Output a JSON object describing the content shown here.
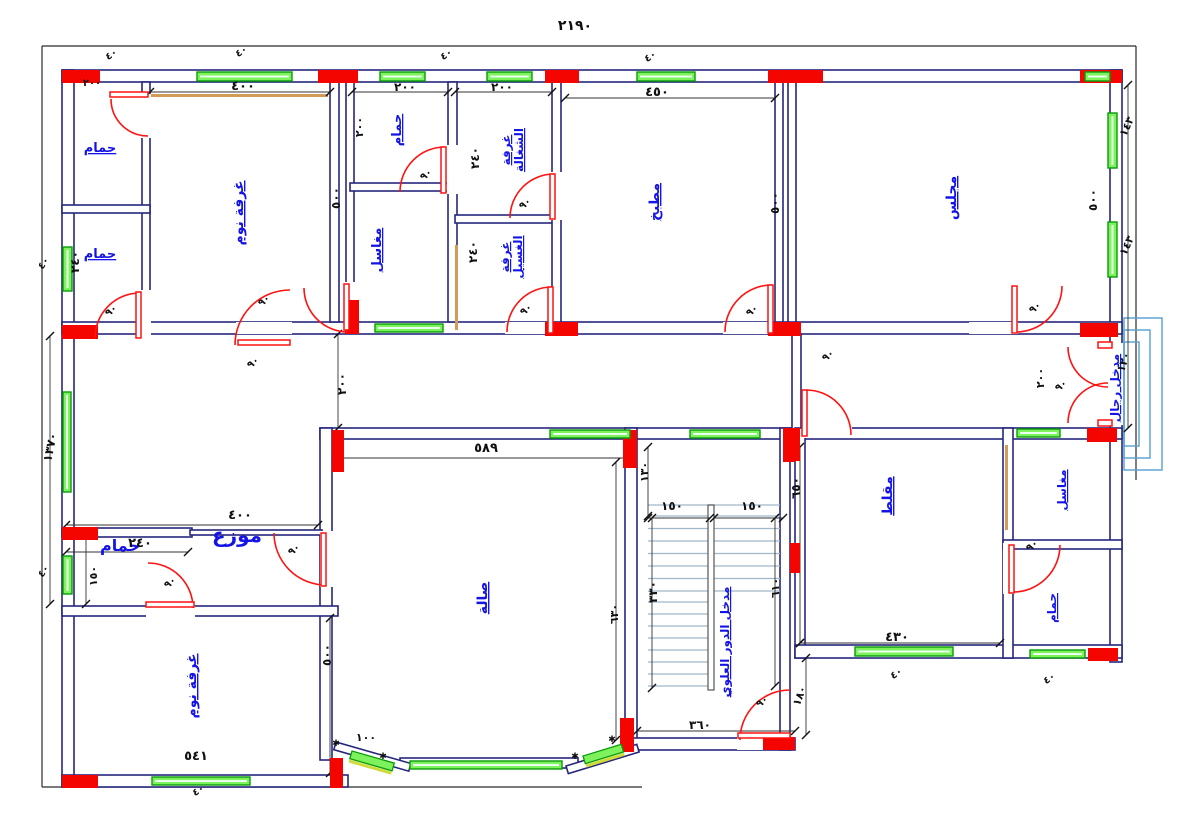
{
  "title": "villa-floor-plan",
  "colors": {
    "wall": "#26267e",
    "boundary": "#2a2a2a",
    "column": "#f50500",
    "window_fill": "#7df25c",
    "window_edge": "#0a9b0a",
    "door": "#ff1212",
    "room_text": "#1414e8",
    "dim_text": "#101010",
    "stairs": "#a0b8ca",
    "entry_steps": "#55a0d0",
    "accent_tan": "#d29b56",
    "bay_accent": "#cddc39"
  },
  "overall_dims": {
    "top_width": "٢١٩٠",
    "left_height": "١٣٧٠"
  },
  "room_labels": [
    {
      "text": "حمام",
      "x": 100,
      "y": 152,
      "rot": 0,
      "size": 13,
      "u": true,
      "stack": false
    },
    {
      "text": "حمام",
      "x": 100,
      "y": 258,
      "rot": 0,
      "size": 13,
      "u": true,
      "stack": false
    },
    {
      "text": "غرفة نوم",
      "x": 243,
      "y": 213,
      "rot": -90,
      "size": 14,
      "u": true,
      "stack": false
    },
    {
      "text": "حمام",
      "x": 401,
      "y": 130,
      "rot": -90,
      "size": 13,
      "u": true,
      "stack": false
    },
    {
      "text": "مغاسل",
      "x": 381,
      "y": 250,
      "rot": -90,
      "size": 13,
      "u": true,
      "stack": false
    },
    {
      "text": "غرفة الشغالة",
      "x": 516,
      "y": 150,
      "rot": -90,
      "size": 12,
      "u": true,
      "stack": true
    },
    {
      "text": "غرفة الغسيل",
      "x": 515,
      "y": 257,
      "rot": -90,
      "size": 12,
      "u": true,
      "stack": true
    },
    {
      "text": "مطبخ",
      "x": 659,
      "y": 202,
      "rot": -90,
      "size": 14,
      "u": true,
      "stack": false
    },
    {
      "text": "مجلس",
      "x": 956,
      "y": 198,
      "rot": -90,
      "size": 14,
      "u": true,
      "stack": false
    },
    {
      "text": "مدخل رجال",
      "x": 1119,
      "y": 388,
      "rot": -90,
      "size": 12,
      "u": true,
      "stack": false
    },
    {
      "text": "مقلط",
      "x": 892,
      "y": 496,
      "rot": -90,
      "size": 14,
      "u": true,
      "stack": false
    },
    {
      "text": "مغاسل",
      "x": 1066,
      "y": 490,
      "rot": -90,
      "size": 12,
      "u": true,
      "stack": false
    },
    {
      "text": "حمام",
      "x": 1056,
      "y": 608,
      "rot": -90,
      "size": 12,
      "u": true,
      "stack": false
    },
    {
      "text": "موزع",
      "x": 237,
      "y": 542,
      "rot": 0,
      "size": 20,
      "u": false,
      "stack": false
    },
    {
      "text": "حمام",
      "x": 120,
      "y": 551,
      "rot": 0,
      "size": 16,
      "u": false,
      "stack": false
    },
    {
      "text": "غرفة نوم",
      "x": 196,
      "y": 686,
      "rot": -90,
      "size": 14,
      "u": true,
      "stack": false
    },
    {
      "text": "صالة",
      "x": 487,
      "y": 598,
      "rot": -90,
      "size": 14,
      "u": true,
      "stack": false
    },
    {
      "text": "مدخل الدور العلوي",
      "x": 729,
      "y": 642,
      "rot": -90,
      "size": 12,
      "u": true,
      "stack": false
    }
  ],
  "dim_labels": [
    {
      "text": "٢١٩٠",
      "x": 575,
      "y": 30,
      "rot": 0,
      "size": 14
    },
    {
      "text": "٤٠٠",
      "x": 243,
      "y": 90,
      "rot": 0,
      "size": 13
    },
    {
      "text": "٢٠٠",
      "x": 405,
      "y": 91,
      "rot": 0,
      "size": 12
    },
    {
      "text": "٢٠٠",
      "x": 502,
      "y": 91,
      "rot": 0,
      "size": 12
    },
    {
      "text": "٤٥٠",
      "x": 657,
      "y": 96,
      "rot": 0,
      "size": 13
    },
    {
      "text": "٢٠٠",
      "x": 92,
      "y": 86,
      "rot": 0,
      "size": 10
    },
    {
      "text": "٥٠٠",
      "x": 340,
      "y": 198,
      "rot": -90,
      "size": 12
    },
    {
      "text": "٢٠٠",
      "x": 363,
      "y": 127,
      "rot": -90,
      "size": 11
    },
    {
      "text": "٢٤٠",
      "x": 479,
      "y": 158,
      "rot": -90,
      "size": 12
    },
    {
      "text": "٢٤٠",
      "x": 477,
      "y": 252,
      "rot": -90,
      "size": 12
    },
    {
      "text": "٥٠٠",
      "x": 779,
      "y": 203,
      "rot": -90,
      "size": 12
    },
    {
      "text": "٥٠٠",
      "x": 1097,
      "y": 200,
      "rot": -90,
      "size": 12
    },
    {
      "text": "١٤٣",
      "x": 1130,
      "y": 128,
      "rot": -65,
      "size": 11
    },
    {
      "text": "١٤٣",
      "x": 1130,
      "y": 247,
      "rot": -65,
      "size": 11
    },
    {
      "text": "٢٤٠",
      "x": 79,
      "y": 262,
      "rot": -90,
      "size": 12
    },
    {
      "text": "١٣٧٠",
      "x": 54,
      "y": 448,
      "rot": -78,
      "size": 12
    },
    {
      "text": "٢٠٠",
      "x": 346,
      "y": 384,
      "rot": -90,
      "size": 12
    },
    {
      "text": "٥٨٩",
      "x": 486,
      "y": 452,
      "rot": 0,
      "size": 13
    },
    {
      "text": "١٣٠",
      "x": 648,
      "y": 472,
      "rot": -90,
      "size": 11
    },
    {
      "text": "١٥٠",
      "x": 672,
      "y": 510,
      "rot": 0,
      "size": 12
    },
    {
      "text": "١٥٠",
      "x": 752,
      "y": 510,
      "rot": 0,
      "size": 12
    },
    {
      "text": "٣٣٠",
      "x": 657,
      "y": 592,
      "rot": -90,
      "size": 12
    },
    {
      "text": "٦١٠",
      "x": 779,
      "y": 588,
      "rot": -90,
      "size": 11
    },
    {
      "text": "٦٣٠",
      "x": 618,
      "y": 614,
      "rot": -90,
      "size": 11
    },
    {
      "text": "٦٥٠",
      "x": 800,
      "y": 488,
      "rot": -90,
      "size": 12
    },
    {
      "text": "١٨٠",
      "x": 803,
      "y": 697,
      "rot": -70,
      "size": 11
    },
    {
      "text": "٣٦٠",
      "x": 700,
      "y": 729,
      "rot": 0,
      "size": 12
    },
    {
      "text": "٤٣٠",
      "x": 897,
      "y": 641,
      "rot": 0,
      "size": 13
    },
    {
      "text": "٤٠٠",
      "x": 240,
      "y": 519,
      "rot": 0,
      "size": 13
    },
    {
      "text": "٢٤٠",
      "x": 140,
      "y": 547,
      "rot": 0,
      "size": 13
    },
    {
      "text": "١٥٠",
      "x": 97,
      "y": 576,
      "rot": -90,
      "size": 11
    },
    {
      "text": "٥٠٠",
      "x": 331,
      "y": 655,
      "rot": -90,
      "size": 12
    },
    {
      "text": "٥٤١",
      "x": 196,
      "y": 760,
      "rot": 0,
      "size": 13
    },
    {
      "text": "١٠٠",
      "x": 366,
      "y": 741,
      "rot": 0,
      "size": 11
    },
    {
      "text": "٢٠٠",
      "x": 1044,
      "y": 378,
      "rot": -90,
      "size": 11
    },
    {
      "text": "١٢٠",
      "x": 1127,
      "y": 363,
      "rot": -72,
      "size": 11
    }
  ],
  "window_tags": [
    {
      "text": "٤٠",
      "x": 113,
      "y": 57,
      "rot": -35
    },
    {
      "text": "٤٠",
      "x": 243,
      "y": 54,
      "rot": -35
    },
    {
      "text": "٤٠",
      "x": 448,
      "y": 57,
      "rot": -35
    },
    {
      "text": "٤٠",
      "x": 652,
      "y": 59,
      "rot": -35
    },
    {
      "text": "٤٠",
      "x": 46,
      "y": 265,
      "rot": -55
    },
    {
      "text": "٤٠",
      "x": 46,
      "y": 573,
      "rot": -55
    },
    {
      "text": "٤٠",
      "x": 200,
      "y": 793,
      "rot": -35
    },
    {
      "text": "٤٠",
      "x": 898,
      "y": 676,
      "rot": -35
    },
    {
      "text": "٤٠",
      "x": 1051,
      "y": 681,
      "rot": -35
    }
  ],
  "door_tags": [
    {
      "text": "٩٠",
      "x": 428,
      "y": 177,
      "rot": -40
    },
    {
      "text": "٩٠",
      "x": 527,
      "y": 206,
      "rot": -40
    },
    {
      "text": "٩٠",
      "x": 528,
      "y": 312,
      "rot": -40
    },
    {
      "text": "٩٠",
      "x": 754,
      "y": 313,
      "rot": -40
    },
    {
      "text": "٩٠",
      "x": 1037,
      "y": 310,
      "rot": -40
    },
    {
      "text": "٩٠",
      "x": 830,
      "y": 358,
      "rot": -40
    },
    {
      "text": "٩٠",
      "x": 1034,
      "y": 548,
      "rot": -40
    },
    {
      "text": "٩٠",
      "x": 296,
      "y": 552,
      "rot": -40
    },
    {
      "text": "٩٠",
      "x": 172,
      "y": 585,
      "rot": -40
    },
    {
      "text": "٩٠",
      "x": 764,
      "y": 704,
      "rot": -40
    },
    {
      "text": "٩٠",
      "x": 113,
      "y": 313,
      "rot": -40
    },
    {
      "text": "٩٠",
      "x": 266,
      "y": 303,
      "rot": -40
    },
    {
      "text": "٩٠",
      "x": 255,
      "y": 365,
      "rot": -40
    },
    {
      "text": "٩٠",
      "x": 1063,
      "y": 388,
      "rot": -40
    }
  ],
  "bay_marks": [
    "✱",
    "✱",
    "✱",
    "✱"
  ]
}
